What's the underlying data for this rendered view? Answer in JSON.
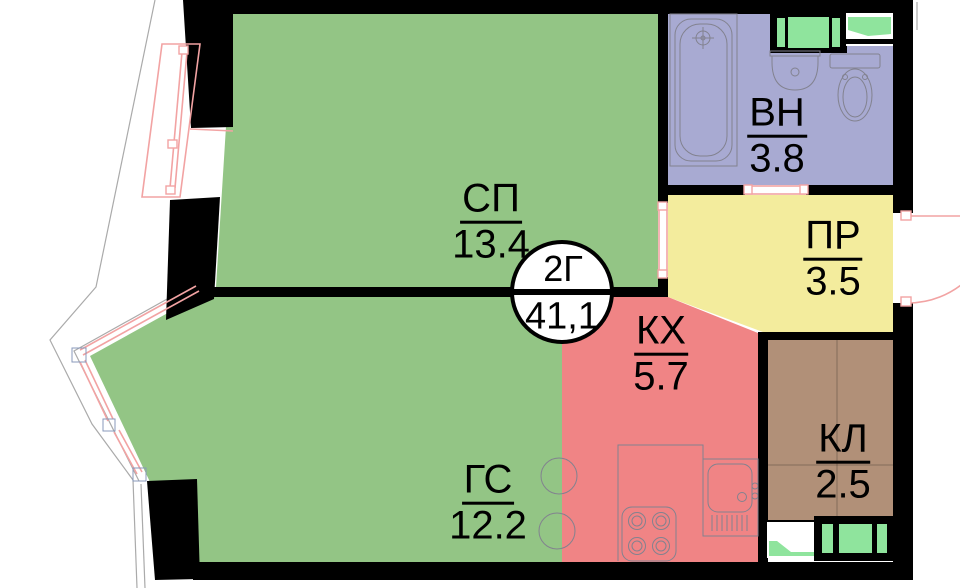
{
  "colors": {
    "room_green": "#93c585",
    "vent_green": "#8fe49d",
    "bath_purple": "#a8aad2",
    "hall_yellow": "#f3ec9d",
    "kitchen_red": "#f08485",
    "closet_brown": "#b19078",
    "wall_black": "#000000",
    "window_pink": "#f2a3a3",
    "fixture_gray": "#82828f",
    "outline_gray": "#aaaaaa"
  },
  "rooms": {
    "sp": {
      "label": "СП",
      "area": "13.4"
    },
    "gs": {
      "label": "ГС",
      "area": "12.2"
    },
    "vn": {
      "label": "ВН",
      "area": "3.8"
    },
    "pr": {
      "label": "ПР",
      "area": "3.5"
    },
    "kh": {
      "label": "КХ",
      "area": "5.7"
    },
    "kl": {
      "label": "КЛ",
      "area": "2.5"
    }
  },
  "badge": {
    "type": "2Г",
    "total": "41,1"
  },
  "fixtures": [
    "bathtub",
    "washbasin",
    "toilet",
    "stove",
    "kitchen-sink",
    "ventilation-shaft",
    "entrance-door",
    "bay-window",
    "balcony-window",
    "dining-stools"
  ]
}
